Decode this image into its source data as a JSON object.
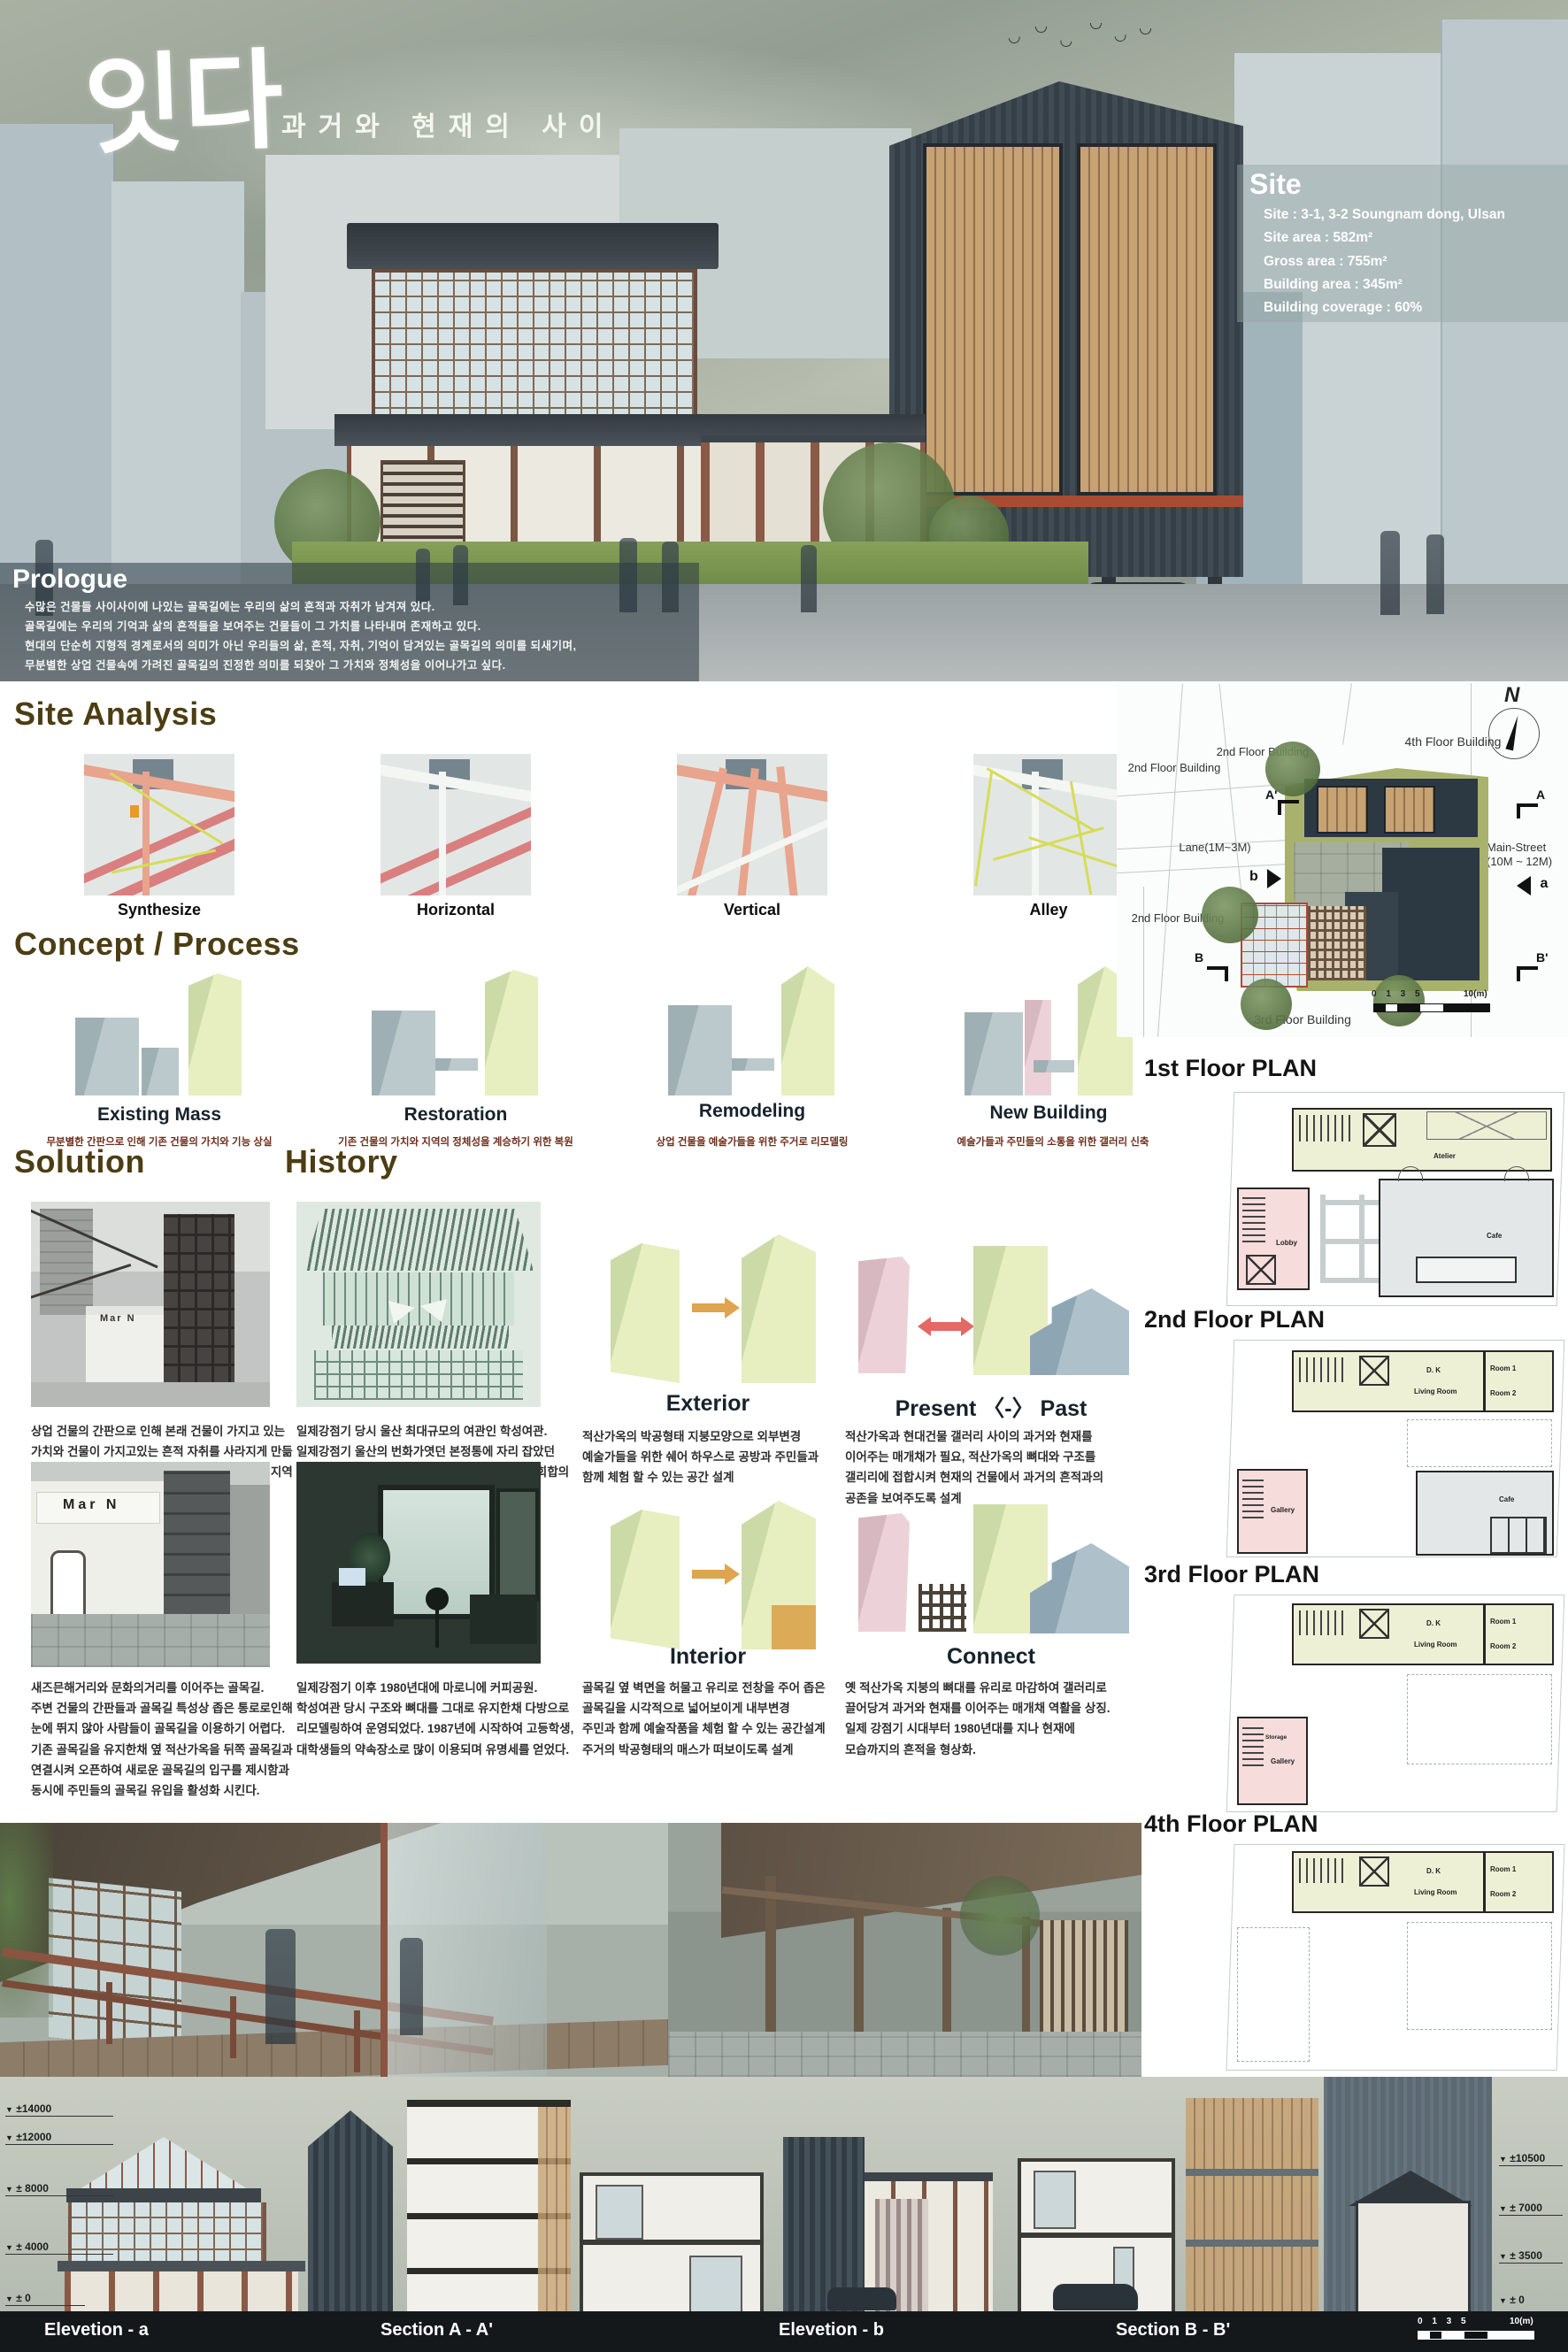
{
  "hero": {
    "title": "잇다",
    "subtitle": "과거와 현재의 사이",
    "site_box": {
      "heading": "Site",
      "lines": [
        "Site : 3-1, 3-2  Soungnam dong, Ulsan",
        "Site area : 582m²",
        "Gross area : 755m²",
        "Building area : 345m²",
        "Building coverage : 60%"
      ]
    },
    "prologue": {
      "heading": "Prologue",
      "lines": [
        "수많은 건물들 사이사이에 나있는 골목길에는 우리의 삶의 흔적과 자취가 남겨져 있다.",
        "골목길에는 우리의 기억과 삶의 흔적들을  보여주는 건물들이 그 가치를 나타내며 존재하고 있다.",
        "현대의 단순히 지형적 경계로서의 의미가 아닌 우리들의 삶, 흔적, 자취, 기억이 담겨있는 골목길의 의미를 되새기며,",
        "무분별한 상업 건물속에 가려진 골목길의 진정한 의미를 되찾아 그 가치와 정체성을 이어나가고 싶다."
      ]
    }
  },
  "site_analysis": {
    "heading": "Site Analysis",
    "maps": [
      {
        "label": "Synthesize"
      },
      {
        "label": "Horizontal"
      },
      {
        "label": "Vertical"
      },
      {
        "label": "Alley"
      }
    ]
  },
  "site_plan": {
    "north": "N",
    "b4f": "4th Floor Building",
    "b2f_left": "2nd Floor Building",
    "b2f_top": "2nd Floor Building",
    "b2f_bottom": "2nd Floor Building",
    "b3f": "3rd Floor Building",
    "lane": "Lane(1M~3M)",
    "main_street": "Main-Street",
    "main_street_width": "(10M ~ 12M)",
    "marker_a_prime": "A'",
    "marker_a": "A",
    "marker_b": "B",
    "marker_b_prime": "B'",
    "arrow_b_label": "b",
    "arrow_a_label": "a",
    "scale_ticks": "0  1    3    5",
    "scale_end": "10(m)"
  },
  "concept": {
    "heading": "Concept / Process",
    "items": [
      {
        "label": "Existing Mass",
        "caption": "무분별한 간판으로 인해 기존 건물의 가치와 기능 상실"
      },
      {
        "label": "Restoration",
        "caption": "기존 건물의 가치와 지역의 정체성을 계승하기 위한 복원"
      },
      {
        "label": "Remodeling",
        "caption": "상업 건물을 예술가들을 위한 주거로 리모델링"
      },
      {
        "label": "New Building",
        "caption": "예술가들과 주민들의 소통을 위한 갤러리 신축"
      }
    ]
  },
  "solution": {
    "heading": "Solution",
    "photo_sign": "Mar N",
    "blocks": [
      {
        "caption": "상업 건물의 간판으로 인해 본래 건물이 가지고 있는\n가치와 건물이 가지고있는 흔적 자취를 사라지게 만듦\n본래 가지고있는 건물의 가치를 복원함과 동시에 지역이\n가지는 정체성을 다음세대까지 계승하도록 한다."
      },
      {
        "caption": "새즈믄해거리와 문화의거리를 이어주는 골목길.\n주변 건물의 간판들과 골목길 특성상 좁은 통로로인해\n눈에 뛰지 않아 사람들이 골목길을 이용하기 어렵다.\n기존 골목길을 유지한채 옆 적산가옥을 뒤쪽 골목길과\n연결시켜 오픈하여 새로운 골목길의 입구를 제시함과\n동시에 주민들의 골목길 유입을 활성화 시킨다."
      }
    ]
  },
  "history": {
    "heading": "History",
    "blocks": [
      {
        "caption": "일제강점기 당시 울산 최대규모의 여관인 학성여관.\n일제강점기 울산의 번화가엿던 본정통에 자리 잡았던\n학성여관은 울산 제일의 여관으로 이곳에서 각종 회합의\n장소로 활용됐으며 숙박으로 각광을 받았다."
      },
      {
        "caption": "일제강점기 이후 1980년대에 마로니에 커피공원.\n학성여관 당시 구조와 뼈대를 그대로 유지한채  다방으로\n리모델링하여 운영되었다. 1987년에 시작하여 고등학생,\n대학생들의 약속장소로 많이 이용되며  유명세를 얻었다."
      }
    ]
  },
  "design": {
    "exterior": {
      "label": "Exterior",
      "caption": "적산가옥의 박공형태 지붕모양으로 외부변경\n예술가들을 위한 쉐어 하우스로 공방과 주민들과\n함께 체험 할 수 있는 공간 설계"
    },
    "present_past": {
      "label": "Present 〈-〉 Past",
      "caption": "적산가옥과 현대건물 갤러리 사이의 과거와 현재를\n이어주는 매개채가 필요, 적산가옥의 뼈대와 구조를\n갤리리에 접합시켜 현재의 건물에서 과거의 흔적과의\n공존을 보여주도록 설계"
    },
    "interior": {
      "label": "Interior",
      "caption": "골목길 옆 벽면을 허물고 유리로 전창을 주어 좁은\n골목길을 시각적으로 넓어보이게 내부변경\n주민과 함께 예술작품을 체험 할 수 있는 공간설계\n주거의 박공형태의 매스가 떠보이도록 설계"
    },
    "connect": {
      "label": "Connect",
      "caption": "옛 적산가옥 지붕의 뼈대를 유리로 마감하여 갤러리로\n끌어당겨 과거와 현재를 이어주는 매개채 역활을 상징.\n일제 강점기 시대부터 1980년대를 지나 현재에\n모습까지의 흔적을 형상화."
    }
  },
  "plans": {
    "p1": {
      "heading": "1st Floor PLAN",
      "atelier": "Atelier",
      "lobby": "Lobby",
      "cafe": "Cafe"
    },
    "p2": {
      "heading": "2nd Floor PLAN",
      "dk": "D. K",
      "living": "Living Room",
      "room1": "Room 1",
      "room2": "Room 2",
      "gallery": "Gallery",
      "cafe": "Cafe"
    },
    "p3": {
      "heading": "3rd Floor PLAN",
      "dk": "D. K",
      "living": "Living Room",
      "room1": "Room 1",
      "room2": "Room 2",
      "gallery": "Gallery",
      "storage": "Storage"
    },
    "p4": {
      "heading": "4th Floor PLAN",
      "dk": "D. K",
      "living": "Living Room",
      "room1": "Room 1",
      "room2": "Room 2"
    }
  },
  "elevations": {
    "left_levels": [
      "±14000",
      "±12000",
      "± 8000",
      "± 4000",
      "± 0"
    ],
    "right_levels": [
      "±10500",
      "± 7000",
      "± 3500",
      "± 0"
    ],
    "captions": [
      "Elevetion - a",
      "Section A - A'",
      "Elevetion - b",
      "Section B - B'"
    ],
    "scale_ticks": "0  1    3    5",
    "scale_end": "10(m)"
  }
}
